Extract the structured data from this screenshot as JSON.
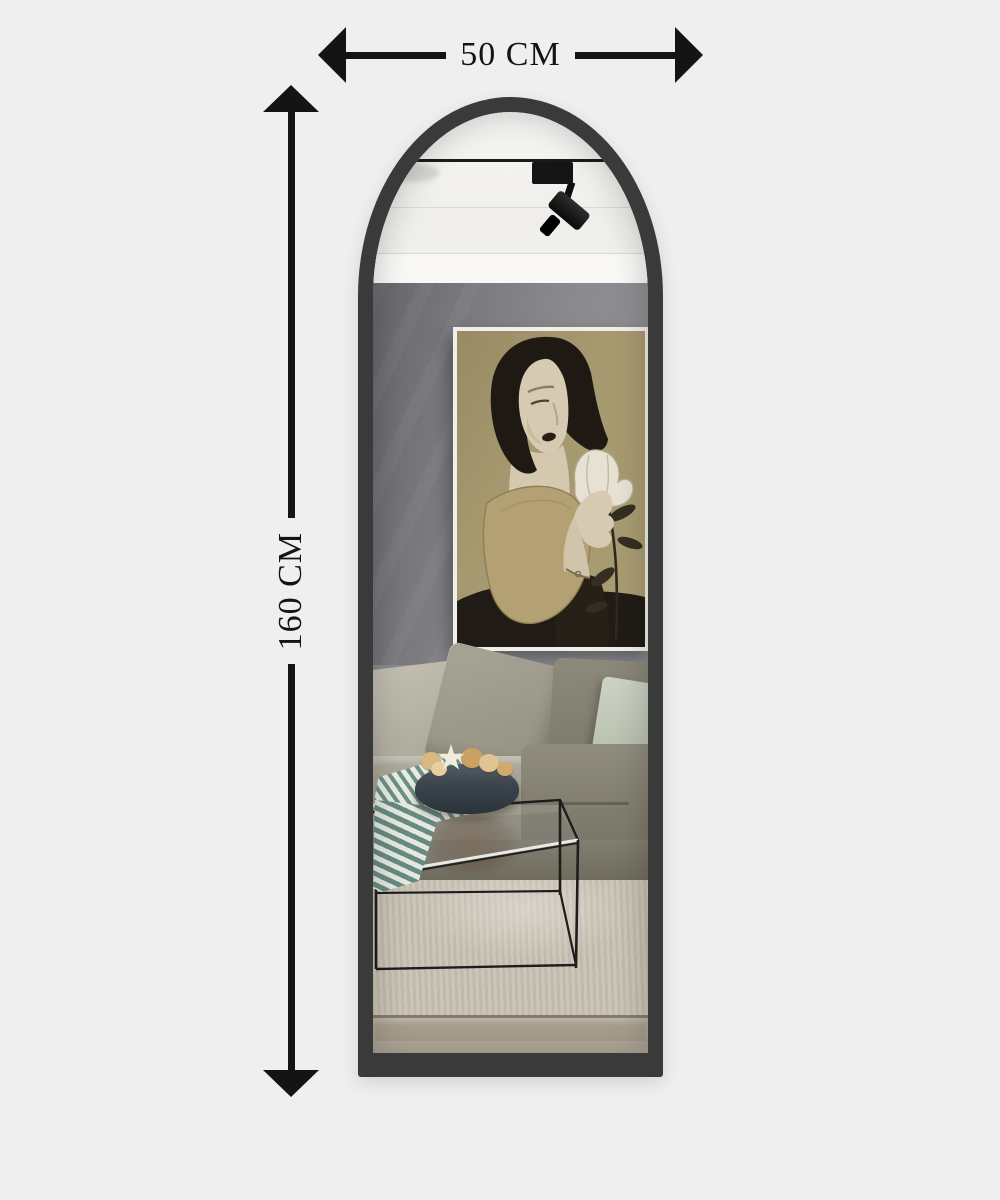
{
  "canvas": {
    "background": "#f0efef"
  },
  "dimensions": {
    "width": {
      "label": "50 CM"
    },
    "height": {
      "label": "160 CM"
    },
    "line_color": "#141414"
  },
  "mirror": {
    "shape": "arched full-length floor mirror",
    "frame_color": "#3a3a3a",
    "reflection_colors": {
      "ceiling": "#f4f3f1",
      "wall": "#87878b",
      "sofa": "#98958a",
      "mint_pillow": "#c3cabb",
      "carpet": "#c8c1b3",
      "artwork_canvas": "#a6996f",
      "cloth_stripe_teal": "#6d9186",
      "bowl": "#3b444c",
      "table_lines": "#1d1d1d"
    },
    "reflected_objects": [
      "track-spotlight",
      "framed-artwork-woman-with-tulip",
      "sofa-with-pillows",
      "mint-pillow",
      "striped-cloth",
      "bowl-of-star-cookies",
      "wireframe-glass-coffee-table",
      "area-rug"
    ]
  }
}
